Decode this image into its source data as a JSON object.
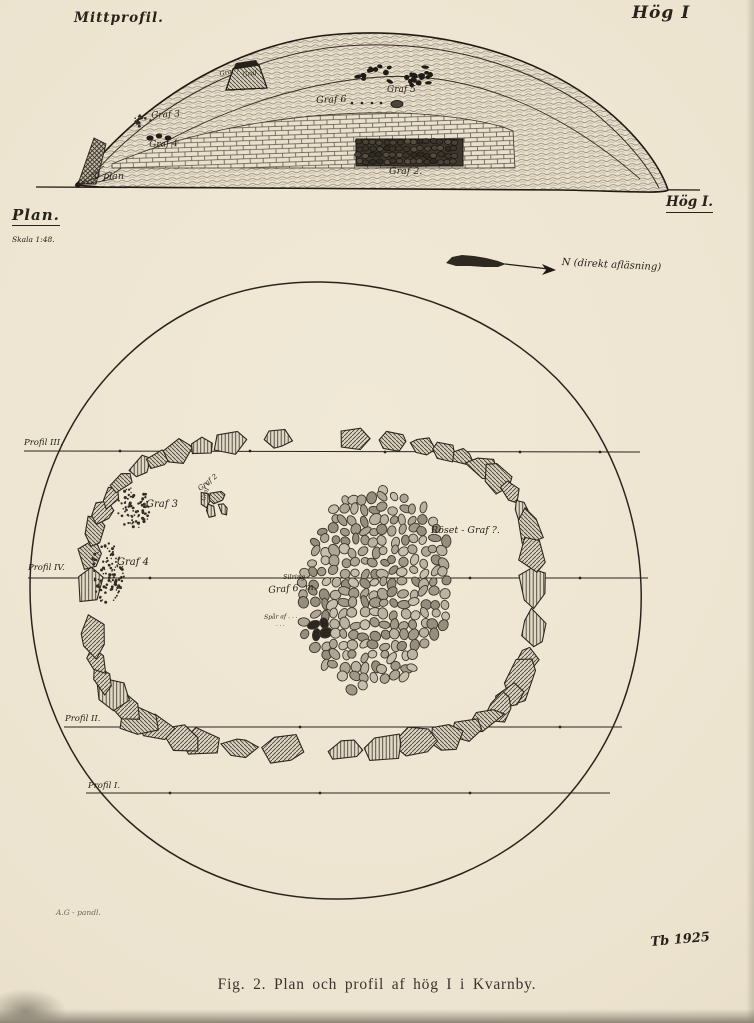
{
  "figure": {
    "caption": "Fig. 2.  Plan och profil af hög I i Kvarnby.",
    "signature": "Tb 1925",
    "pencil_note": "A.G - pandl.",
    "colors": {
      "paper": "#ece3d0",
      "ink": "#27221a",
      "pencil": "#6f685c"
    }
  },
  "profile": {
    "title": "Mittprofil.",
    "mound_label": "Hög I",
    "zero_plane": "0 plan",
    "graves": {
      "graf7": "Graf 7",
      "graf1": "Graf 1",
      "graf5": "Graf 5",
      "graf6": "Graf 6",
      "graf3": "Graf 3",
      "graf4": "Graf 4",
      "graf2": "Graf 2."
    }
  },
  "plan": {
    "title": "Plan.",
    "scale": "Skala 1:48.",
    "mound_label": "Hög I.",
    "north_label": "N (direkt afläsning)",
    "profile_lines": {
      "iii": "Profil III.",
      "iv": "Profil IV.",
      "ii": "Profil II.",
      "i": "Profil I."
    },
    "features": {
      "graf3": "Graf 3",
      "graf2": "Graf 2",
      "graf1": "Graf 1",
      "graf4": "Graf 4",
      "roset": "Röset - Graf ?.",
      "silring": "Silring",
      "graf6": "Graf 6, m.",
      "spar1": "Spår af . . .",
      "spar2": ". . ."
    }
  }
}
